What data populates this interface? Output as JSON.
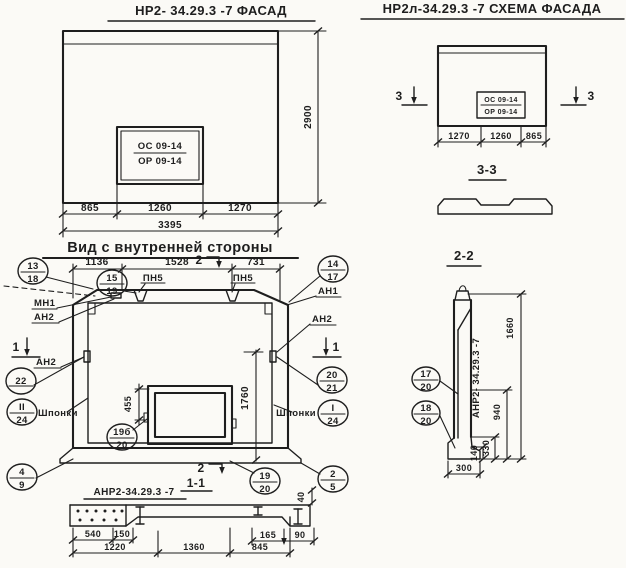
{
  "colors": {
    "paper": "#fbfaf6",
    "ink": "#1e1e1e"
  },
  "facade": {
    "title": "НР2- 34.29.3 -7 ФАСАД",
    "stamp_top": "ОС 09-14",
    "stamp_bottom": "ОР 09-14",
    "dim_height": "2900",
    "dim_a": "865",
    "dim_b": "1260",
    "dim_c": "1270",
    "dim_total": "3395"
  },
  "scheme": {
    "title": "НР2л-34.29.3 -7 СХЕМА ФАСАДА",
    "stamp_top": "ОС 09-14",
    "stamp_bottom": "ОР 09-14",
    "dim_a": "1270",
    "dim_b": "1260",
    "dim_c": "865",
    "marker": "3",
    "section_title": "3-3"
  },
  "inner": {
    "title": "Вид с внутренней стороны",
    "dim_a": "1136",
    "dim_b": "1528",
    "dim_c": "731",
    "dim_window": "455",
    "dim_height": "1760",
    "dim_step": "40",
    "marker_v": "1",
    "marker_h": "2",
    "label_mn1": "МН1",
    "label_an1": "АН1",
    "label_an2": "АН2",
    "label_pn5": "ПН5",
    "label_keys": "Шпонки",
    "callouts": {
      "c13_18": {
        "top": "13",
        "bot": "18"
      },
      "c15_19": {
        "top": "15",
        "bot": "19"
      },
      "c14_17": {
        "top": "14",
        "bot": "17"
      },
      "c20_21": {
        "top": "20",
        "bot": "21"
      },
      "c1_24": {
        "top": "I",
        "bot": "24"
      },
      "c22": {
        "top": "22",
        "bot": ""
      },
      "c11_24": {
        "top": "II",
        "bot": "24"
      },
      "c19b_20": {
        "top": "19б",
        "bot": "20"
      },
      "c4_9": {
        "top": "4",
        "bot": "9"
      },
      "c19_20": {
        "top": "19",
        "bot": "20"
      },
      "c2_5": {
        "top": "2",
        "bot": "5"
      }
    }
  },
  "section11": {
    "title": "1-1",
    "label": "АНР2-34.29.3 -7",
    "dim_540": "540",
    "dim_150": "150",
    "dim_1220": "1220",
    "dim_1360": "1360",
    "dim_845": "845",
    "dim_165": "165",
    "dim_90": "90"
  },
  "section22": {
    "title": "2-2",
    "label_vertical": "АНР2- 34.29.3 -7",
    "dim_1660": "1660",
    "dim_940": "940",
    "dim_330": "330",
    "dim_140": "140",
    "dim_300": "300",
    "callouts": {
      "c17_20": {
        "top": "17",
        "bot": "20"
      },
      "c18_20": {
        "top": "18",
        "bot": "20"
      }
    }
  }
}
